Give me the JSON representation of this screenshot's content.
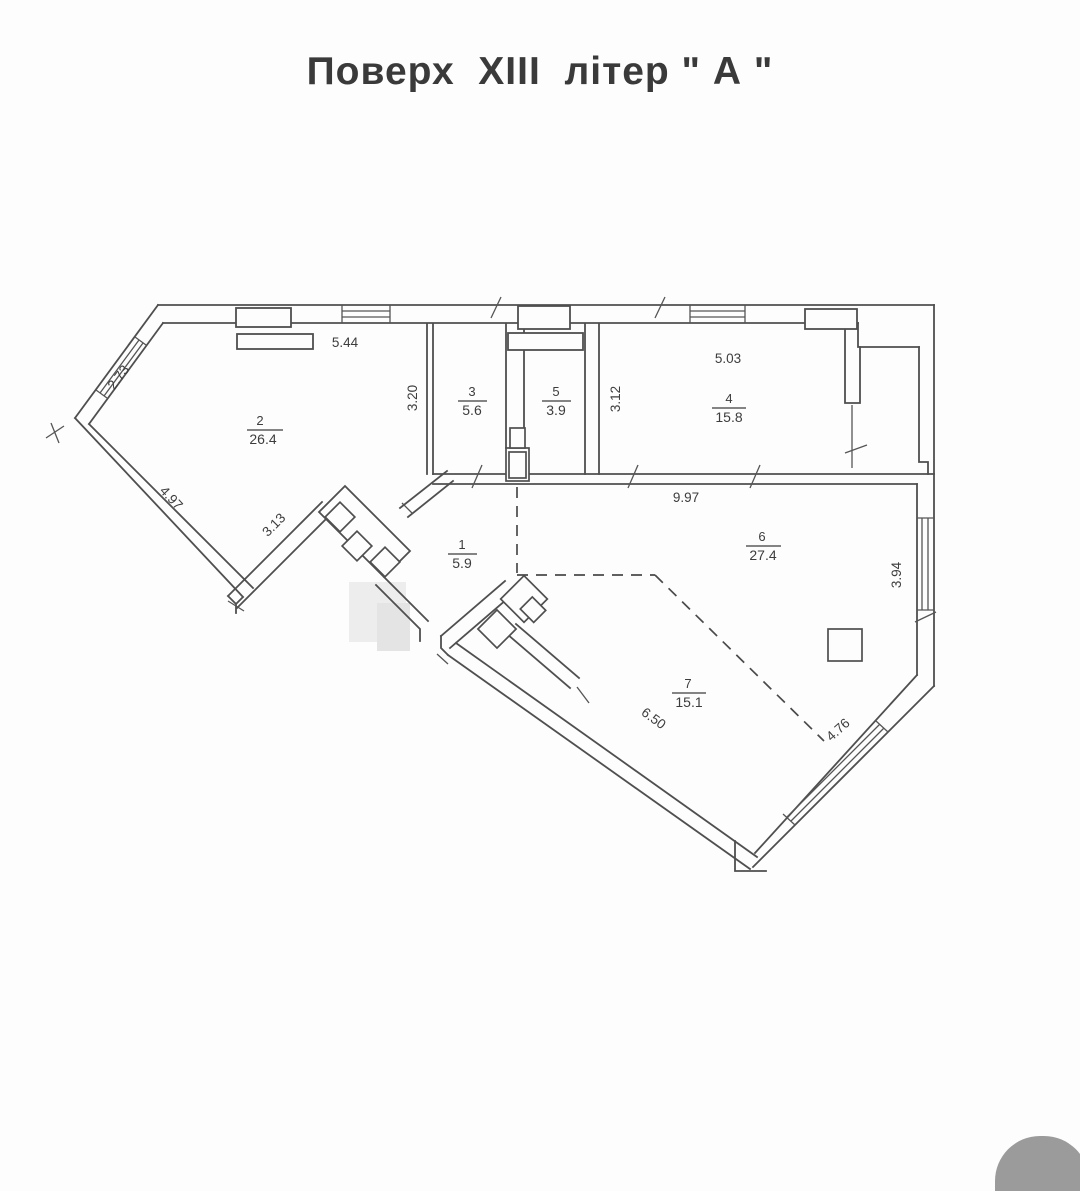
{
  "title": "Поверх  XIII  літер \" А \"",
  "rooms": {
    "r1": {
      "number": "1",
      "area": "5.9"
    },
    "r2": {
      "number": "2",
      "area": "26.4"
    },
    "r3": {
      "number": "3",
      "area": "5.6"
    },
    "r4": {
      "number": "4",
      "area": "15.8"
    },
    "r5": {
      "number": "5",
      "area": "3.9"
    },
    "r6": {
      "number": "6",
      "area": "27.4"
    },
    "r7": {
      "number": "7",
      "area": "15.1"
    }
  },
  "dimensions": {
    "top_width": "5.44",
    "nw_window_wall": "2.73",
    "room2_height": "3.20",
    "room5_height": "3.12",
    "room4_width": "5.03",
    "west_wall_upper": "4.97",
    "west_wall_lower": "3.13",
    "interior_width": "9.97",
    "east_window_wall": "3.94",
    "sw_wall": "6.50",
    "se_window_wall": "4.76"
  },
  "colors": {
    "line": "#4f4f4f",
    "scan_blob": "#9b9b9b"
  }
}
